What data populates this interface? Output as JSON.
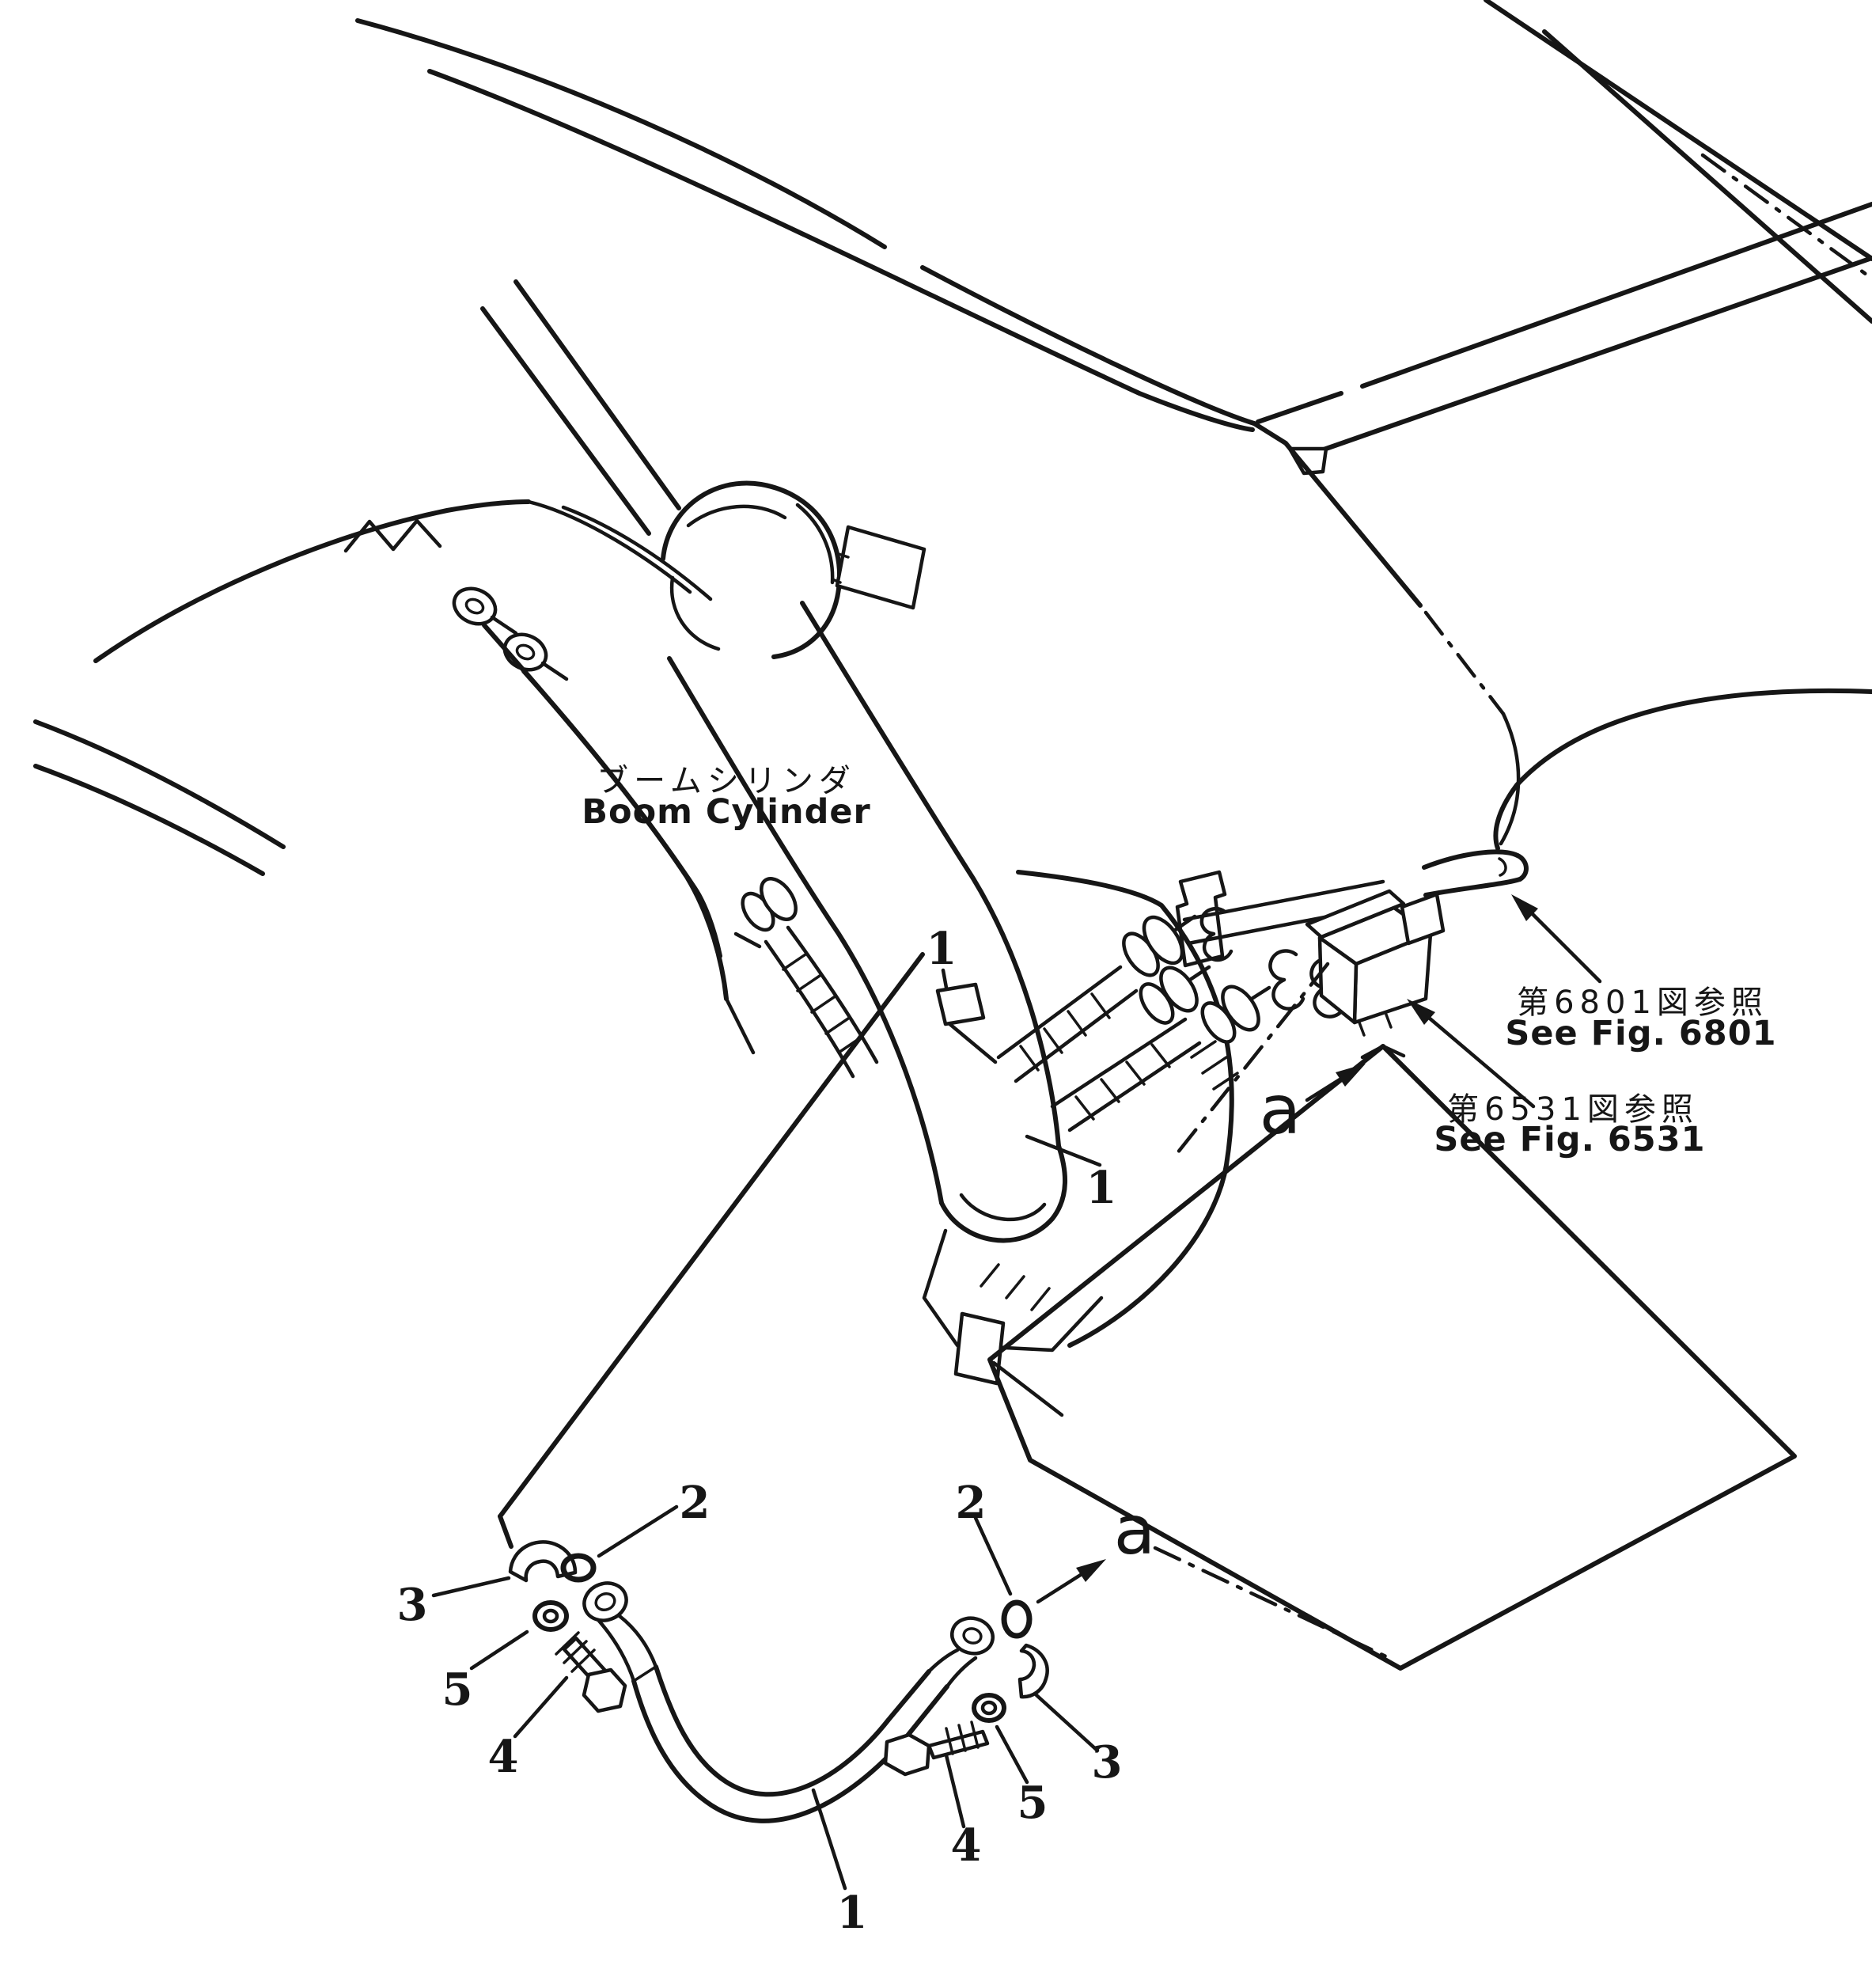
{
  "page": {
    "background": "#ffffff",
    "ink": "#161616",
    "kind": "hydraulic piping parts diagram"
  },
  "diagram": {
    "component_label": {
      "ja": "ブームシリンダ",
      "en": "Boom Cylinder"
    },
    "references": [
      {
        "ja": "第6801図参照",
        "en": "See Fig. 6801"
      },
      {
        "ja": "第6531図参照",
        "en": "See Fig. 6531"
      }
    ],
    "section_markers": [
      "a",
      "a"
    ],
    "callouts": [
      "1",
      "1",
      "1",
      "2",
      "2",
      "3",
      "3",
      "4",
      "4",
      "5",
      "5"
    ]
  }
}
